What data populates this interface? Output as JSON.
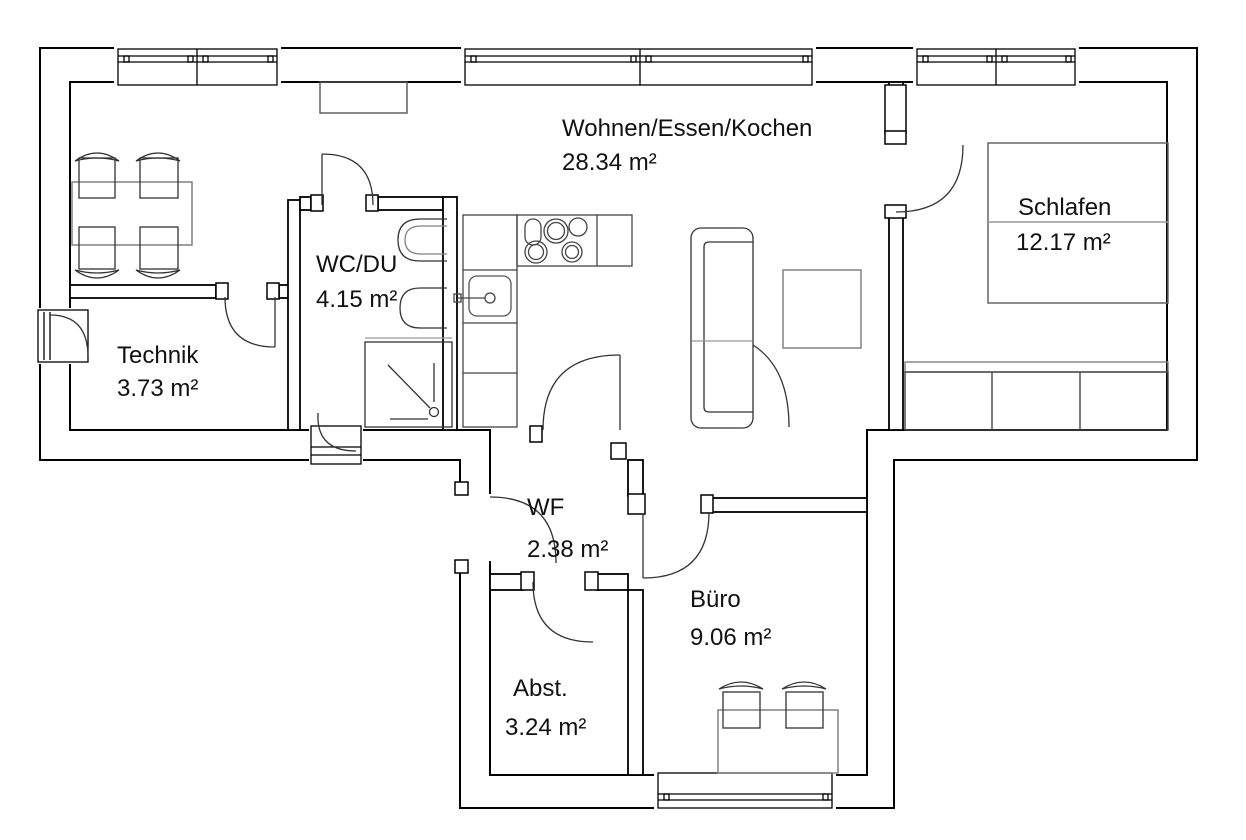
{
  "rooms": {
    "wohnen": {
      "name": "Wohnen/Essen/Kochen",
      "area": "28.34 m²"
    },
    "schlafen": {
      "name": "Schlafen",
      "area": "12.17 m²"
    },
    "wcdu": {
      "name": "WC/DU",
      "area": "4.15 m²"
    },
    "technik": {
      "name": "Technik",
      "area": "3.73 m²"
    },
    "wf": {
      "name": "WF",
      "area": "2.38 m²"
    },
    "buero": {
      "name": "Büro",
      "area": "9.06 m²"
    },
    "abst": {
      "name": "Abst.",
      "area": "3.24 m²"
    }
  },
  "colors": {
    "background": "#ffffff",
    "wall": "#000000",
    "door_arc": "#333333",
    "furniture_dark": "#444444",
    "furniture_light": "#808080",
    "text": "#111111"
  },
  "icons": {
    "furniture": [
      "dining-table",
      "dining-chair",
      "sideboard",
      "kitchen-counter",
      "kitchen-sink",
      "cooktop",
      "sofa",
      "coffee-table",
      "bed",
      "wardrobe",
      "shower",
      "toilet",
      "washbasin",
      "desk",
      "office-chair"
    ],
    "doors": [
      "technik-door",
      "wcdu-door",
      "bedroom-door",
      "wf-wohnen-door",
      "entrance-door",
      "buero-door",
      "abst-door",
      "exterior-door-left",
      "exterior-door-bottom"
    ],
    "windows": [
      "top-window-left",
      "top-window-center",
      "top-window-right",
      "buero-window"
    ]
  }
}
